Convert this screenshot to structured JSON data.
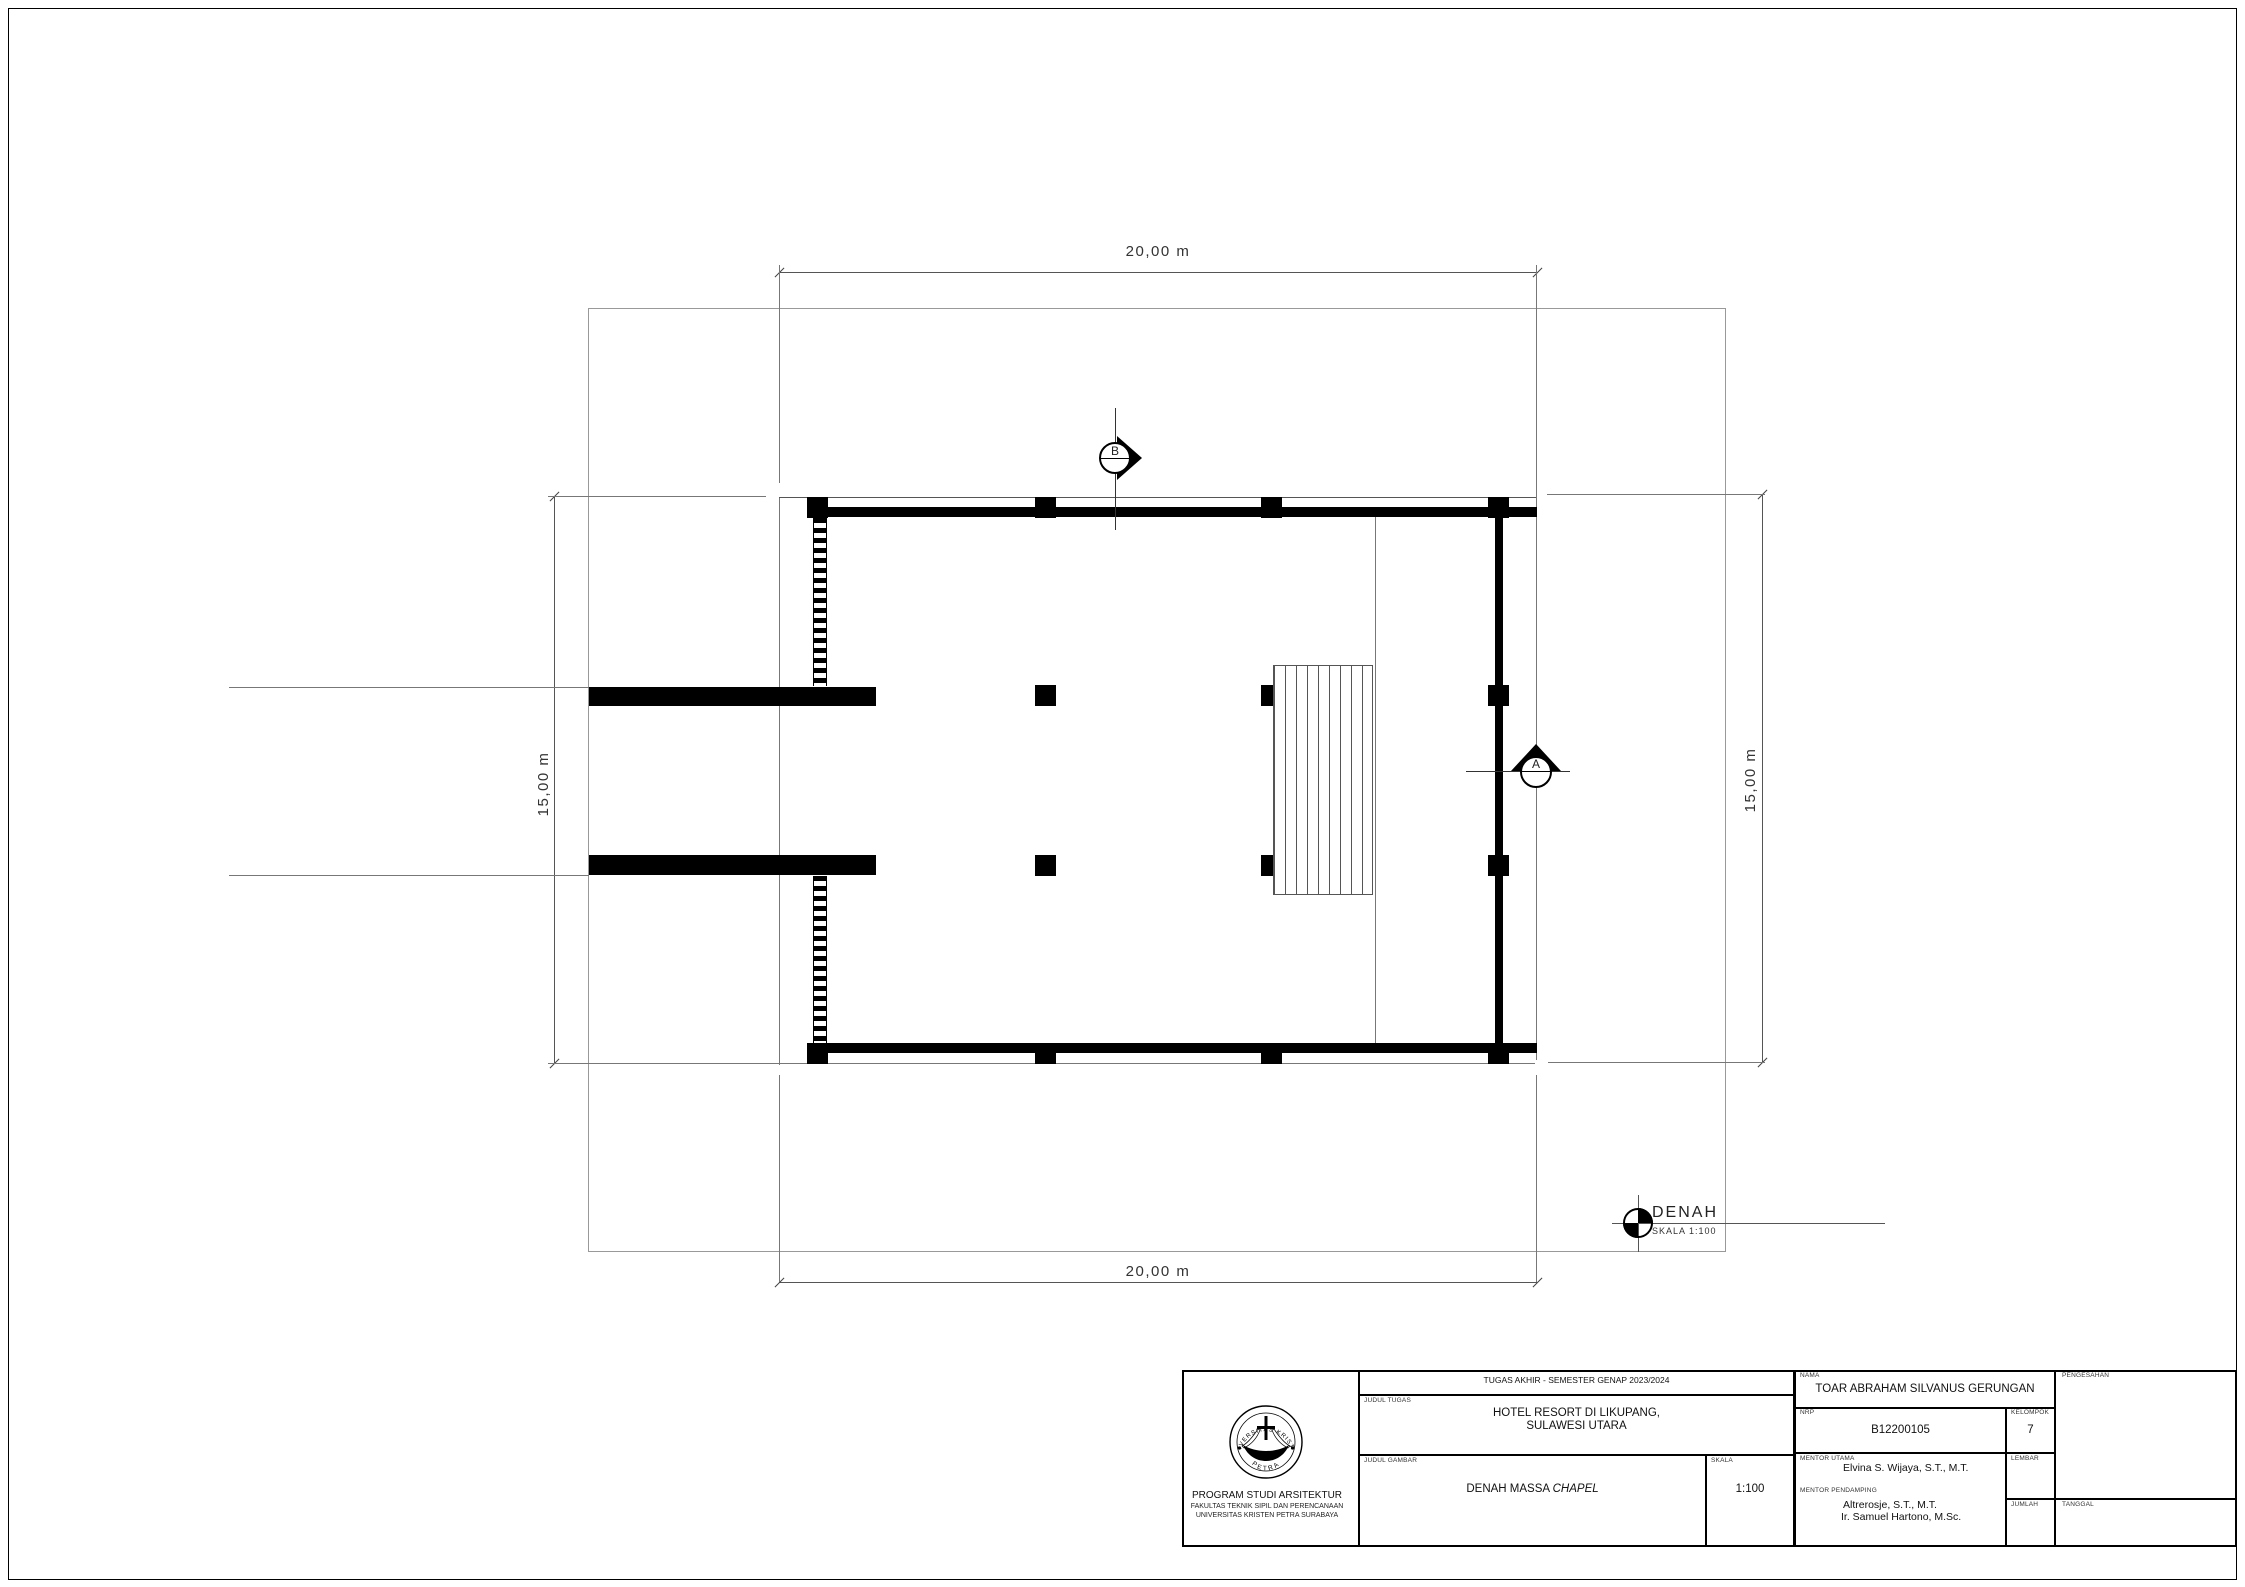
{
  "dimensions": {
    "top": "20,00 m",
    "bottom": "20,00 m",
    "left": "15,00 m",
    "right": "15,00 m"
  },
  "sections": {
    "a": "A",
    "b": "B"
  },
  "drawing_label": {
    "title": "DENAH",
    "scale": "SKALA 1:100"
  },
  "title_block": {
    "institution": {
      "logo_text_top": "UNIVERSITAS KRISTEN",
      "logo_text_bottom": "PETRA",
      "program": "PROGRAM STUDI ARSITEKTUR",
      "faculty": "FAKULTAS TEKNIK SIPIL DAN PERENCANAAN",
      "university": "UNIVERSITAS KRISTEN PETRA SURABAYA"
    },
    "project": {
      "header": "TUGAS AKHIR - SEMESTER GENAP 2023/2024",
      "judul_tugas_label": "JUDUL TUGAS",
      "judul_tugas_line1": "HOTEL RESORT DI LIKUPANG,",
      "judul_tugas_line2": "SULAWESI UTARA",
      "judul_gambar_label": "JUDUL GAMBAR",
      "judul_gambar": "DENAH MASSA",
      "judul_gambar_italic": "CHAPEL",
      "skala_label": "SKALA",
      "skala_value": "1:100"
    },
    "student": {
      "nama_label": "NAMA",
      "nama": "TOAR ABRAHAM SILVANUS GERUNGAN",
      "nrp_label": "NRP",
      "nrp": "B12200105",
      "kelompok_label": "KELOMPOK",
      "kelompok": "7",
      "mentor_utama_label": "MENTOR UTAMA",
      "mentor_utama": "Elvina S. Wijaya, S.T., M.T.",
      "mentor_pendamping_label": "MENTOR PENDAMPING",
      "mentor_pendamping_1": "Altrerosje, S.T., M.T.",
      "mentor_pendamping_2": "Ir. Samuel Hartono, M.Sc.",
      "lembar_label": "LEMBAR",
      "jumlah_label": "JUMLAH",
      "pengesahan_label": "PENGESAHAN",
      "tanggal_label": "TANGGAL"
    }
  }
}
